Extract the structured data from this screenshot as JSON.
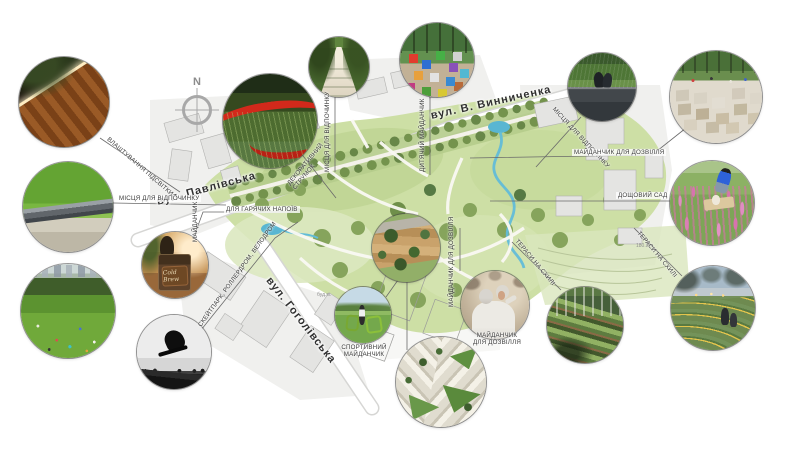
{
  "compass": {
    "north_label": "N"
  },
  "streets": {
    "pavlivska": {
      "label": "вул. Павлівська"
    },
    "vynnychenka": {
      "label": "вул. В. Винниченка"
    },
    "hoholivska": {
      "label": "вул. Гоголівська"
    }
  },
  "callouts": {
    "lighting": {
      "label": "ВЛАШТУВАННЯ ПІДСВІТКИ"
    },
    "rest_left": {
      "label": "МІСЦЯ ДЛЯ ВІДПОЧИНКУ"
    },
    "hot_drinks_vertical": {
      "label": "МАЙДАНЧИК"
    },
    "hot_drinks_horizontal": {
      "label": "ДЛЯ ГАРЯЧИХ НАПОЇВ"
    },
    "skatepark": {
      "label": "СКЕЙТПАРК, РОЛЛЕРДРОМ, ВЕЛОДРОМ"
    },
    "rest_alley": {
      "label": "МІСЦЯ ДЛЯ ВІДПОЧИНКУ"
    },
    "decorative_stream": {
      "line1": "ДЕКОРАТИВНИЙ",
      "line2": "СТРУМОК"
    },
    "kids_playground": {
      "label": "ДИТЯЧИЙ МАЙДАНЧИК"
    },
    "rest_right": {
      "label": "МІСЦЯ ДЛЯ ВІДПОЧИНКУ"
    },
    "leisure_top_right": {
      "label": "МАЙДАНЧИК ДЛЯ ДОЗВІЛЛЯ"
    },
    "rain_garden": {
      "label": "ДОЩОВИЙ САД"
    },
    "terraces_left": {
      "label": "ТЕРАСИ НА СХИЛІ"
    },
    "terraces_right": {
      "label": "ТЕРАСИ НА СХИЛІ"
    },
    "leisure_center": {
      "label": "МАЙДАНЧИК ДЛЯ ДОЗВІЛЛЯ"
    },
    "sports": {
      "line1": "СПОРТИВНИЙ",
      "line2": "МАЙДАНЧИК"
    },
    "leisure_dance": {
      "line1": "МАЙДАНЧИК",
      "line2": "ДЛЯ ДОЗВІЛЛЯ"
    }
  },
  "photo_details": {
    "coffee_cart_sign": "Cold Brew"
  },
  "map_annotations": {
    "building_note": "буд.м.",
    "elevation_mark": "180.8+"
  },
  "photos": [
    "wood-bench-lighting",
    "lawn-bench",
    "park-lawn-people",
    "red-garden-path",
    "coffee-cart",
    "skateboarder",
    "tree-alley-benches",
    "colorful-cubes-playground",
    "aerial-wood-deck",
    "outdoor-gym",
    "dancing-couple",
    "aerial-paving-pattern",
    "stone-wall-seating",
    "stone-blocks-plaza",
    "rain-garden-flowers",
    "terraced-planting",
    "evening-amphitheater"
  ],
  "colors": {
    "park_green": "#cddfa5",
    "tree_green": "#74934d",
    "water_blue": "#59b6d2",
    "red_path": "#d2291b",
    "accent_yellow": "#e3c44d",
    "street_text": "#2f2f2f",
    "callout_text": "#3b3b3b",
    "leader_line": "#6a6a6a",
    "building_fill": "#e4e4e2"
  }
}
